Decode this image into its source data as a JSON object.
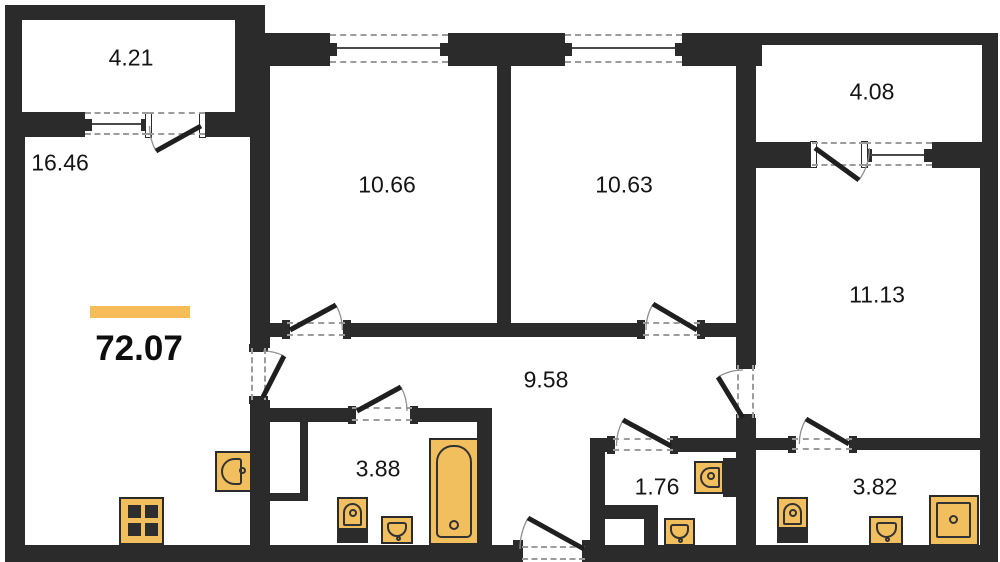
{
  "plan": {
    "title": "apartment-floor-plan",
    "total_area": "72.07",
    "rooms": [
      {
        "id": "balcony-left",
        "area": "4.21"
      },
      {
        "id": "living-room",
        "area": "16.46"
      },
      {
        "id": "bedroom-1",
        "area": "10.66"
      },
      {
        "id": "bedroom-2",
        "area": "10.63"
      },
      {
        "id": "balcony-right",
        "area": "4.08"
      },
      {
        "id": "bedroom-3",
        "area": "11.13"
      },
      {
        "id": "hallway",
        "area": "9.58"
      },
      {
        "id": "bathroom",
        "area": "3.88"
      },
      {
        "id": "wc",
        "area": "1.76"
      },
      {
        "id": "ensuite-bath",
        "area": "3.82"
      }
    ],
    "colors": {
      "wall": "#2b2b2b",
      "fixture": "#f2bf5f",
      "accent_bar": "#f5bd57",
      "background": "#ffffff"
    }
  }
}
